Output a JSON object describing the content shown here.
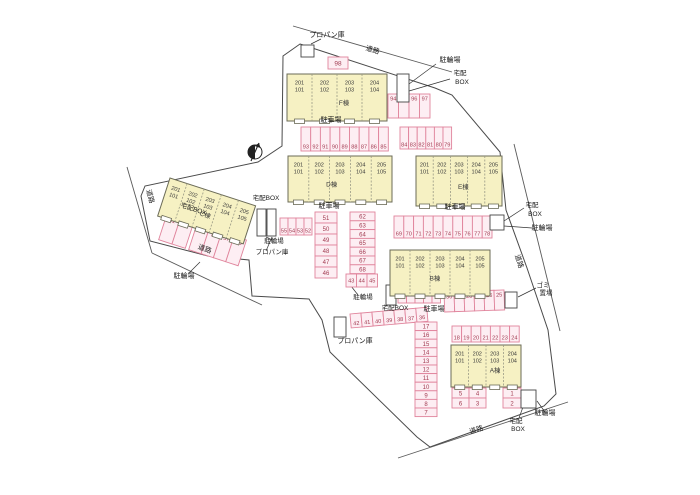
{
  "title": "apartment-site-plan",
  "colors": {
    "background": "#ffffff",
    "boundary": "#4a4a4a",
    "road_line": "#5a5a5a",
    "leader": "#333333",
    "building_fill": "#f6f1c3",
    "building_stroke": "#6b6b57",
    "unit_divider": "#9a9a85",
    "unit_text": "#3a3a3a",
    "parking_fill": "#fdeef3",
    "parking_stroke": "#e0849c",
    "parking_number": "#a23c52",
    "label_text": "#1a1a1a",
    "white_box_stroke": "#444444",
    "compass": "#222222"
  },
  "buildings": [
    {
      "name": "building-F",
      "label": "F棟",
      "x": 287,
      "y": 74,
      "w": 100,
      "h": 47,
      "rotate": 0,
      "label_fx": 0.57,
      "units": [
        [
          "201",
          "101"
        ],
        [
          "202",
          "102"
        ],
        [
          "203",
          "103"
        ],
        [
          "204",
          "104"
        ]
      ]
    },
    {
      "name": "building-D",
      "label": "D棟",
      "x": 288,
      "y": 156,
      "w": 104,
      "h": 46,
      "rotate": 0,
      "label_fx": 0.42,
      "units": [
        [
          "201",
          "101"
        ],
        [
          "202",
          "102"
        ],
        [
          "203",
          "103"
        ],
        [
          "204",
          "104"
        ],
        [
          "205",
          "105"
        ]
      ]
    },
    {
      "name": "building-E",
      "label": "E棟",
      "x": 416,
      "y": 156,
      "w": 86,
      "h": 50,
      "rotate": 0,
      "label_fx": 0.55,
      "units": [
        [
          "201",
          "101"
        ],
        [
          "202",
          "102"
        ],
        [
          "203",
          "103"
        ],
        [
          "204",
          "104"
        ],
        [
          "205",
          "105"
        ]
      ]
    },
    {
      "name": "building-C",
      "label": "C棟",
      "x": 170,
      "y": 178,
      "w": 90,
      "h": 40,
      "rotate": 18,
      "label_fx": 0.5,
      "units": [
        [
          "201",
          "101"
        ],
        [
          "202",
          "102"
        ],
        [
          "203",
          "103"
        ],
        [
          "204",
          "104"
        ],
        [
          "205",
          "105"
        ]
      ]
    },
    {
      "name": "building-B",
      "label": "B棟",
      "x": 390,
      "y": 250,
      "w": 100,
      "h": 46,
      "rotate": 0,
      "label_fx": 0.45,
      "units": [
        [
          "201",
          "101"
        ],
        [
          "202",
          "102"
        ],
        [
          "203",
          "103"
        ],
        [
          "204",
          "104"
        ],
        [
          "205",
          "105"
        ]
      ]
    },
    {
      "name": "building-A",
      "label": "A棟",
      "x": 451,
      "y": 345,
      "w": 70,
      "h": 42,
      "rotate": 0,
      "label_fx": 0.63,
      "units": [
        [
          "201",
          "101"
        ],
        [
          "202",
          "102"
        ],
        [
          "203",
          "103"
        ],
        [
          "204",
          "104"
        ]
      ]
    }
  ],
  "parking_groups": [
    {
      "name": "lot-98",
      "x": 328,
      "y": 57,
      "cell_w": 20,
      "cell_h": 12,
      "dir": "row",
      "rotate": 0,
      "num_pos": "center",
      "fs": 6.5,
      "numbers": [
        "98"
      ]
    },
    {
      "name": "lot-94-97",
      "x": 388,
      "y": 94,
      "cell_w": 10.5,
      "cell_h": 24,
      "dir": "row",
      "rotate": 0,
      "num_pos": "top",
      "fs": 5.6,
      "numbers": [
        "94",
        "95",
        "96",
        "97"
      ]
    },
    {
      "name": "lot-93-85",
      "x": 301,
      "y": 127,
      "cell_w": 9.7,
      "cell_h": 24,
      "dir": "row",
      "rotate": 0,
      "num_pos": "bottom",
      "fs": 5.6,
      "numbers": [
        "93",
        "92",
        "91",
        "90",
        "89",
        "88",
        "87",
        "86",
        "85"
      ]
    },
    {
      "name": "lot-84-79",
      "x": 400,
      "y": 127,
      "cell_w": 8.6,
      "cell_h": 22,
      "dir": "row",
      "rotate": 0,
      "num_pos": "bottom",
      "fs": 5.6,
      "numbers": [
        "84",
        "83",
        "82",
        "81",
        "80",
        "79"
      ]
    },
    {
      "name": "lot-55-52",
      "x": 280,
      "y": 218,
      "cell_w": 8,
      "cell_h": 17,
      "dir": "row",
      "rotate": 0,
      "num_pos": "bottom",
      "fs": 5.6,
      "numbers": [
        "55",
        "54",
        "53",
        "52"
      ]
    },
    {
      "name": "lot-51-46",
      "x": 315,
      "y": 212,
      "cell_w": 22,
      "cell_h": 11,
      "dir": "col",
      "rotate": 0,
      "num_pos": "center",
      "fs": 6,
      "numbers": [
        "51",
        "50",
        "49",
        "48",
        "47",
        "46"
      ]
    },
    {
      "name": "lot-62-68",
      "x": 350,
      "y": 212,
      "cell_w": 25,
      "cell_h": 8.8,
      "dir": "col",
      "rotate": 0,
      "num_pos": "center",
      "fs": 6,
      "numbers": [
        "62",
        "63",
        "64",
        "65",
        "66",
        "67",
        "68"
      ]
    },
    {
      "name": "lot-43-45",
      "x": 346,
      "y": 274,
      "cell_w": 10.5,
      "cell_h": 13,
      "dir": "row",
      "rotate": 0,
      "num_pos": "center",
      "fs": 5.6,
      "numbers": [
        "43",
        "44",
        "45"
      ]
    },
    {
      "name": "lot-61-60",
      "x": 167,
      "y": 214,
      "cell_w": 14,
      "cell_h": 27,
      "dir": "row",
      "rotate": 18,
      "num_pos": "top",
      "fs": 5.6,
      "numbers": [
        "61",
        "60"
      ]
    },
    {
      "name": "lot-59-56",
      "x": 197,
      "y": 224,
      "cell_w": 13,
      "cell_h": 27,
      "dir": "row",
      "rotate": 18,
      "num_pos": "top",
      "fs": 5.6,
      "numbers": [
        "59",
        "58",
        "57",
        "56"
      ]
    },
    {
      "name": "lot-69-78",
      "x": 394,
      "y": 216,
      "cell_w": 9.8,
      "cell_h": 22,
      "dir": "row",
      "rotate": 0,
      "num_pos": "bottom",
      "fs": 5.6,
      "numbers": [
        "69",
        "70",
        "71",
        "72",
        "73",
        "74",
        "75",
        "76",
        "77",
        "78"
      ]
    },
    {
      "name": "lot-35-31",
      "x": 398,
      "y": 287,
      "cell_w": 8.5,
      "cell_h": 16,
      "dir": "row",
      "rotate": 0,
      "num_pos": "top",
      "fs": 5.6,
      "numbers": [
        "35",
        "34",
        "33",
        "32",
        "31"
      ]
    },
    {
      "name": "lot-30-25",
      "x": 444,
      "y": 292,
      "cell_w": 10,
      "cell_h": 20,
      "dir": "row",
      "rotate": -2,
      "num_pos": "top",
      "fs": 5.6,
      "numbers": [
        "30",
        "29",
        "28",
        "27",
        "26",
        "25"
      ]
    },
    {
      "name": "lot-42-36",
      "x": 350,
      "y": 314,
      "cell_w": 11,
      "cell_h": 14,
      "dir": "row",
      "rotate": -5,
      "num_pos": "bottom",
      "fs": 5.6,
      "numbers": [
        "42",
        "41",
        "40",
        "39",
        "38",
        "37",
        "36"
      ]
    },
    {
      "name": "lot-17-7",
      "x": 415,
      "y": 322,
      "cell_w": 22,
      "cell_h": 8.6,
      "dir": "col",
      "rotate": 0,
      "num_pos": "center",
      "fs": 6,
      "numbers": [
        "17",
        "16",
        "15",
        "14",
        "13",
        "12",
        "11",
        "10",
        "9",
        "8",
        "7"
      ]
    },
    {
      "name": "lot-18-24",
      "x": 452,
      "y": 326,
      "cell_w": 9.6,
      "cell_h": 16,
      "dir": "row",
      "rotate": 0,
      "num_pos": "bottom",
      "fs": 5.6,
      "numbers": [
        "18",
        "19",
        "20",
        "21",
        "22",
        "23",
        "24"
      ]
    },
    {
      "name": "lot-5-4",
      "x": 452,
      "y": 388,
      "cell_w": 17,
      "cell_h": 10,
      "dir": "row",
      "rotate": 0,
      "num_pos": "center",
      "fs": 6,
      "numbers": [
        "5",
        "4"
      ]
    },
    {
      "name": "lot-6-3",
      "x": 452,
      "y": 398,
      "cell_w": 17,
      "cell_h": 10,
      "dir": "row",
      "rotate": 0,
      "num_pos": "center",
      "fs": 6,
      "numbers": [
        "6",
        "3"
      ]
    },
    {
      "name": "lot-1-2",
      "x": 503,
      "y": 388,
      "cell_w": 18,
      "cell_h": 10,
      "dir": "col",
      "rotate": 0,
      "num_pos": "center",
      "fs": 6,
      "numbers": [
        "1",
        "2"
      ]
    }
  ],
  "white_boxes": [
    {
      "name": "propane-box-top",
      "x": 301,
      "y": 45,
      "w": 13,
      "h": 12
    },
    {
      "name": "delivery-bike-box-ne",
      "x": 397,
      "y": 74,
      "w": 12,
      "h": 28
    },
    {
      "name": "bike-box-center",
      "x": 257,
      "y": 209,
      "w": 9,
      "h": 27
    },
    {
      "name": "propane-box-center",
      "x": 267,
      "y": 209,
      "w": 9,
      "h": 27
    },
    {
      "name": "delivery-box-east",
      "x": 490,
      "y": 215,
      "w": 14,
      "h": 15
    },
    {
      "name": "delivery-box-b",
      "x": 386,
      "y": 285,
      "w": 10,
      "h": 20
    },
    {
      "name": "garbage-box",
      "x": 505,
      "y": 292,
      "w": 12,
      "h": 16
    },
    {
      "name": "propane-box-bottom",
      "x": 334,
      "y": 317,
      "w": 12,
      "h": 20
    },
    {
      "name": "delivery-bike-box-se",
      "x": 521,
      "y": 390,
      "w": 15,
      "h": 18
    }
  ],
  "labels": [
    {
      "name": "label-propane-top",
      "text": "プロパン庫",
      "x": 327,
      "y": 37,
      "rotate": 0,
      "fs": 7
    },
    {
      "name": "label-road-top",
      "text": "道路",
      "x": 372,
      "y": 52,
      "rotate": 17,
      "fs": 7
    },
    {
      "name": "label-bike-ne",
      "text": "駐輪場",
      "x": 450,
      "y": 62,
      "rotate": 0,
      "fs": 7
    },
    {
      "name": "label-delivery-ne-1",
      "text": "宅配",
      "x": 460,
      "y": 75,
      "rotate": 0,
      "fs": 6.5
    },
    {
      "name": "label-delivery-ne-2",
      "text": "BOX",
      "x": 462,
      "y": 84,
      "rotate": 0,
      "fs": 6.5
    },
    {
      "name": "label-parking-f",
      "text": "駐車場",
      "x": 331,
      "y": 122,
      "rotate": 0,
      "fs": 7
    },
    {
      "name": "label-delivery-d",
      "text": "宅配BOX",
      "x": 266,
      "y": 200,
      "rotate": 0,
      "fs": 6.5
    },
    {
      "name": "label-parking-d",
      "text": "駐車場",
      "x": 329,
      "y": 208,
      "rotate": 0,
      "fs": 7
    },
    {
      "name": "label-parking-e",
      "text": "駐車場",
      "x": 455,
      "y": 209,
      "rotate": 0,
      "fs": 7
    },
    {
      "name": "label-road-left",
      "text": "道路",
      "x": 148,
      "y": 197,
      "rotate": 75,
      "fs": 7
    },
    {
      "name": "label-delivery-c",
      "text": "宅配BOX",
      "x": 193,
      "y": 211,
      "rotate": 18,
      "fs": 6.5
    },
    {
      "name": "label-road-left2",
      "text": "道路",
      "x": 204,
      "y": 251,
      "rotate": 20,
      "fs": 7
    },
    {
      "name": "label-bike-sw",
      "text": "駐輪場",
      "x": 184,
      "y": 278,
      "rotate": 0,
      "fs": 7
    },
    {
      "name": "label-bike-center",
      "text": "駐輪場",
      "x": 274,
      "y": 243,
      "rotate": 0,
      "fs": 6.5
    },
    {
      "name": "label-propane-center",
      "text": "プロパン庫",
      "x": 272,
      "y": 254,
      "rotate": 0,
      "fs": 6.5
    },
    {
      "name": "label-delivery-e-1",
      "text": "宅配",
      "x": 532,
      "y": 207,
      "rotate": 0,
      "fs": 6.5
    },
    {
      "name": "label-delivery-e-2",
      "text": "BOX",
      "x": 535,
      "y": 216,
      "rotate": 0,
      "fs": 6.5
    },
    {
      "name": "label-bike-e",
      "text": "駐輪場",
      "x": 542,
      "y": 230,
      "rotate": 0,
      "fs": 7
    },
    {
      "name": "label-road-right",
      "text": "道路",
      "x": 517,
      "y": 262,
      "rotate": 72,
      "fs": 7
    },
    {
      "name": "label-bike-mid",
      "text": "駐輪場",
      "x": 363,
      "y": 299,
      "rotate": 0,
      "fs": 6.5
    },
    {
      "name": "label-delivery-b",
      "text": "宅配BOX",
      "x": 395,
      "y": 310,
      "rotate": 0,
      "fs": 6.5
    },
    {
      "name": "label-parking-b",
      "text": "駐車場",
      "x": 434,
      "y": 311,
      "rotate": 0,
      "fs": 7
    },
    {
      "name": "label-garbage-1",
      "text": "ゴミ",
      "x": 543,
      "y": 287,
      "rotate": 0,
      "fs": 6.5
    },
    {
      "name": "label-garbage-2",
      "text": "置場",
      "x": 546,
      "y": 295,
      "rotate": 0,
      "fs": 6.5
    },
    {
      "name": "label-propane-bottom",
      "text": "プロパン庫",
      "x": 355,
      "y": 343,
      "rotate": 0,
      "fs": 7
    },
    {
      "name": "label-delivery-se-1",
      "text": "宅配",
      "x": 516,
      "y": 423,
      "rotate": 0,
      "fs": 6.5
    },
    {
      "name": "label-delivery-se-2",
      "text": "BOX",
      "x": 518,
      "y": 431,
      "rotate": 0,
      "fs": 6.5
    },
    {
      "name": "label-bike-se",
      "text": "駐輪場",
      "x": 545,
      "y": 415,
      "rotate": 0,
      "fs": 7
    },
    {
      "name": "label-road-bottom",
      "text": "道路",
      "x": 477,
      "y": 432,
      "rotate": -17,
      "fs": 7
    }
  ],
  "geometry": {
    "boundary_points": "300,44 435,88 452,95 500,152 506,210 527,268 548,330 556,394 544,406 430,447 417,437 330,352 322,320 309,299 252,296 249,260 208,256 150,241 141,196 145,186 258,162 282,146 283,56",
    "roads": [
      {
        "x1": 293,
        "y1": 26,
        "x2": 452,
        "y2": 72
      },
      {
        "x1": 127,
        "y1": 167,
        "x2": 152,
        "y2": 253
      },
      {
        "x1": 152,
        "y1": 253,
        "x2": 262,
        "y2": 305
      },
      {
        "x1": 514,
        "y1": 144,
        "x2": 560,
        "y2": 331
      },
      {
        "x1": 398,
        "y1": 458,
        "x2": 568,
        "y2": 402
      }
    ],
    "leaders": [
      {
        "x1": 409,
        "y1": 84,
        "x2": 436,
        "y2": 64
      },
      {
        "x1": 409,
        "y1": 91,
        "x2": 450,
        "y2": 79
      },
      {
        "x1": 311,
        "y1": 44,
        "x2": 321,
        "y2": 39
      },
      {
        "x1": 266,
        "y1": 237,
        "x2": 272,
        "y2": 240
      },
      {
        "x1": 272,
        "y1": 237,
        "x2": 266,
        "y2": 251
      },
      {
        "x1": 504,
        "y1": 221,
        "x2": 524,
        "y2": 208
      },
      {
        "x1": 504,
        "y1": 226,
        "x2": 532,
        "y2": 228
      },
      {
        "x1": 518,
        "y1": 297,
        "x2": 536,
        "y2": 288
      },
      {
        "x1": 527,
        "y1": 396,
        "x2": 519,
        "y2": 418
      },
      {
        "x1": 537,
        "y1": 401,
        "x2": 545,
        "y2": 412
      },
      {
        "x1": 200,
        "y1": 262,
        "x2": 189,
        "y2": 273
      },
      {
        "x1": 351,
        "y1": 286,
        "x2": 358,
        "y2": 295
      }
    ]
  },
  "compass": {
    "cx": 255,
    "cy": 152,
    "r": 7
  }
}
